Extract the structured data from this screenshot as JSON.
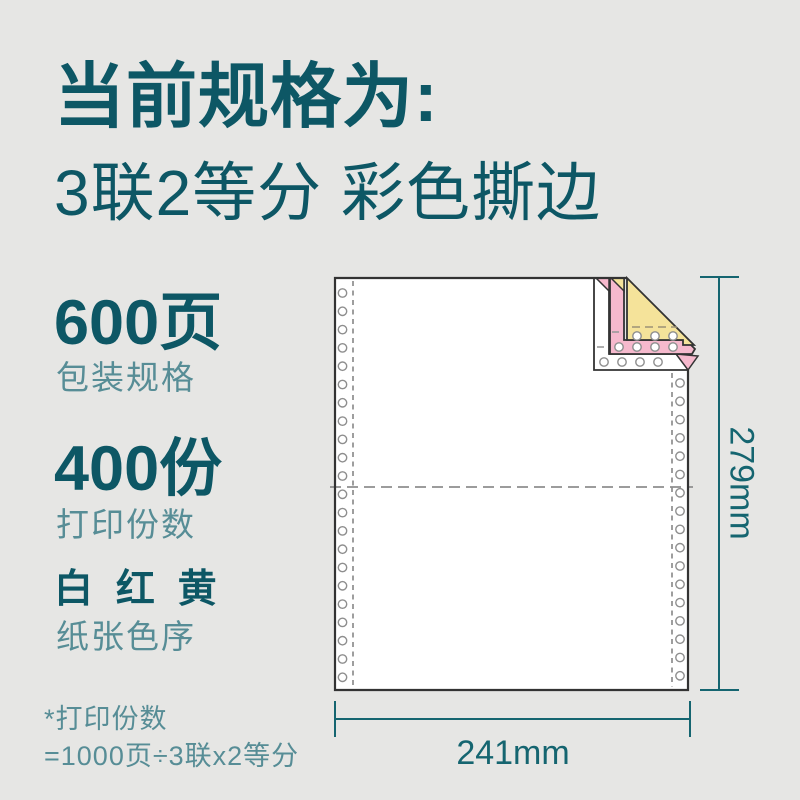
{
  "header": {
    "title": "当前规格为:",
    "subtitle": "3联2等分 彩色撕边"
  },
  "specs": [
    {
      "value": "600页",
      "label": "包装规格"
    },
    {
      "value": "400份",
      "label": "打印份数"
    },
    {
      "value": "白 红 黄",
      "label": "纸张色序"
    }
  ],
  "footnote": {
    "line1": "*打印份数",
    "line2": "=1000页÷3联x2等分"
  },
  "diagram": {
    "width_label": "241mm",
    "height_label": "279mm",
    "ply_colors": {
      "ply1_white": "#ffffff",
      "ply2_red": "#f6b9cd",
      "ply3_yellow": "#f5e39a"
    }
  },
  "colors": {
    "heading": "#0d5765",
    "subtext": "#578d96",
    "dimension": "#156570",
    "outline": "#333333",
    "background": "#e6e6e4"
  }
}
